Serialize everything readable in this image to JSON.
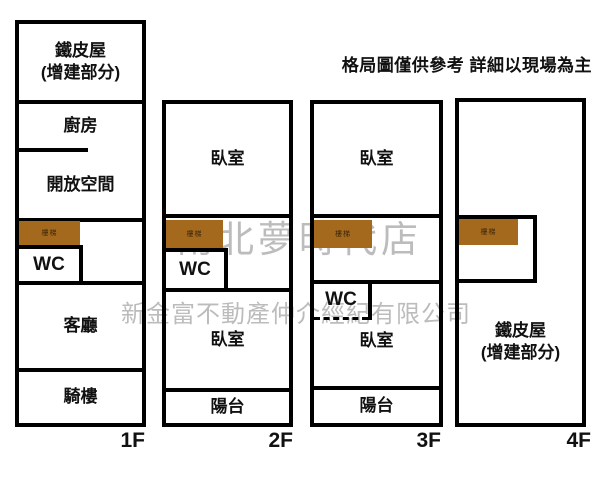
{
  "disclaimer": "格局圖僅供參考 詳細以現場為主",
  "watermark": {
    "store_name": "南北夢時代店",
    "company_name": "新金富不動產仲介經紀有限公司"
  },
  "colors": {
    "wall": "#000000",
    "stairs_fill": "#a5691e",
    "watermark": "#bcbcbc"
  },
  "floor1": {
    "label": "1F",
    "tin_roof_line1": "鐵皮屋",
    "tin_roof_line2": "(增建部分)",
    "kitchen": "廚房",
    "open_space": "開放空間",
    "stairs": "樓梯",
    "wc": "WC",
    "living_room": "客廳",
    "arcade": "騎樓"
  },
  "floor2": {
    "label": "2F",
    "bedroom_top": "臥室",
    "stairs": "樓梯",
    "wc": "WC",
    "bedroom_bottom": "臥室",
    "balcony": "陽台"
  },
  "floor3": {
    "label": "3F",
    "bedroom_top": "臥室",
    "stairs": "樓梯",
    "wc": "WC",
    "bedroom_bottom": "臥室",
    "balcony": "陽台"
  },
  "floor4": {
    "label": "4F",
    "stairs": "樓梯",
    "tin_roof_line1": "鐵皮屋",
    "tin_roof_line2": "(增建部分)"
  }
}
